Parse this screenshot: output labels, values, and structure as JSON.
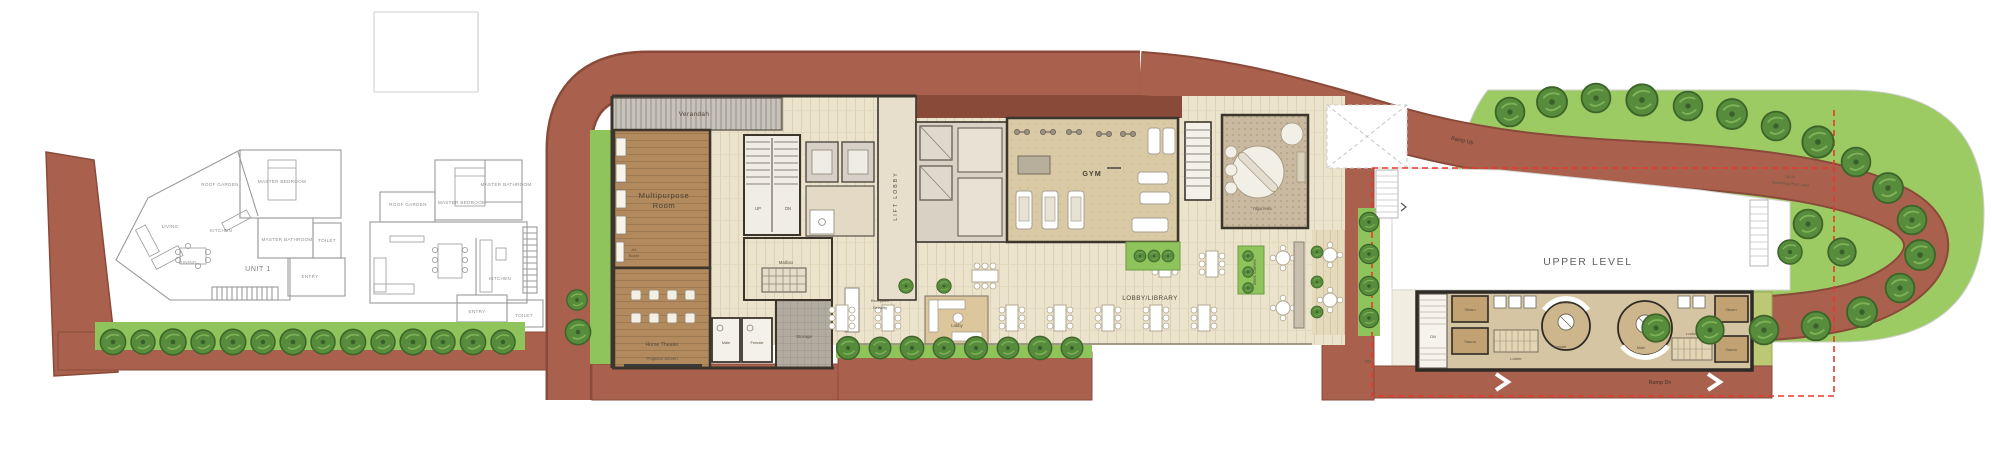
{
  "unit1": {
    "title": "UNIT 1",
    "roof_garden": "ROOF GARDEN",
    "master_bedroom": "MASTER BEDROOM",
    "master_bathroom": "MASTER BATHROOM",
    "living": "LIVING",
    "dining": "DINING",
    "kitchen": "KITCHEN",
    "toilet": "TOILET",
    "entry": "ENTRY"
  },
  "unit2": {
    "roof_garden": "ROOF GARDEN",
    "master_bedroom": "MASTER BEDROOM",
    "master_bathroom": "MASTER BATHROOM",
    "kitchen": "KITCHEN",
    "entry": "ENTRY",
    "toilet": "TOILET"
  },
  "clubhouse": {
    "verandah": "Verandah",
    "multipurpose_line1": "Multipurpose",
    "multipurpose_line2": "Room",
    "art_line1": "Art",
    "art_line2": "Board",
    "home_theater": "Home Theater",
    "projector_screen": "Projector Screen",
    "up": "UP",
    "dn": "DN",
    "lift_lobby": "LIFT LOBBY",
    "mailbox": "Mailbox",
    "storage": "Storage",
    "male": "Male",
    "female": "Female",
    "reception_line1": "Reception/",
    "reception_line2": "Security",
    "lobby": "Lobby",
    "lobby_library": "LOBBY/LIBRARY",
    "gym": "GYM",
    "yoga_area": "Yoga Area",
    "book_shelves": "Book Shelves"
  },
  "upper_zone": {
    "upper_level": "UPPER LEVEL",
    "ramp_up": "Ramp Up",
    "ramp_dn": "Ramp Dn",
    "up": "UP",
    "dn": "DN",
    "steam": "Steam",
    "sauna": "Sauna",
    "locker": "Locker",
    "female": "Female",
    "male": "Male",
    "shower": "Shower",
    "pool_line1": "Up to",
    "pool_line2": "Swimming Pool Level"
  },
  "colors": {
    "road": "#a9614d",
    "road_dark": "#8a4a3a",
    "grass": "#8fc45c",
    "lawn": "#9ccb64",
    "tree": "#568c3b",
    "wood": "#b28a5e",
    "gym_floor": "#d9c9a4",
    "paving": "#ece3cd",
    "boundary_red": "#e8382c",
    "wall": "#3b352c"
  }
}
